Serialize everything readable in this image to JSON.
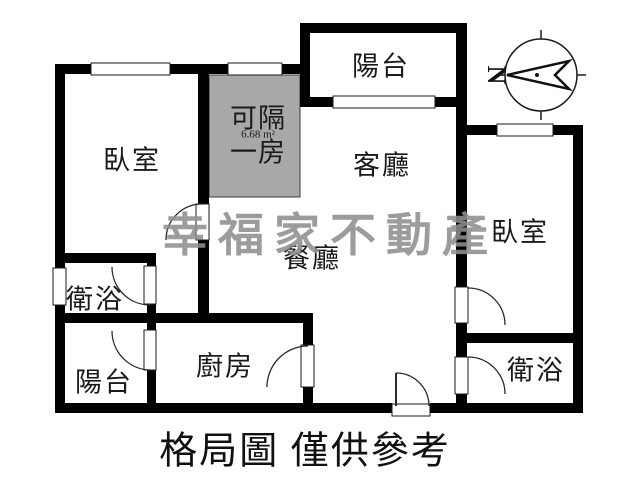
{
  "caption": "格局圖 僅供參考",
  "watermark": "幸福家不動產",
  "compass": {
    "north_label": "N"
  },
  "rooms": {
    "bedroom_top_left": "臥室",
    "bedroom_right": "臥室",
    "living_room": "客廳",
    "dining_room": "餐廳",
    "kitchen": "廚房",
    "bathroom_left": "衛浴",
    "bathroom_bottom_right": "衛浴",
    "balcony_top": "陽台",
    "balcony_bottom_left": "陽台",
    "convertible_room": {
      "line1": "可隔",
      "line2": "一房",
      "area": "6.68 m²"
    }
  },
  "colors": {
    "wall": "#000000",
    "convertible_fill": "#a8a8a8",
    "watermark": "#8f8f8f",
    "background": "#ffffff"
  }
}
